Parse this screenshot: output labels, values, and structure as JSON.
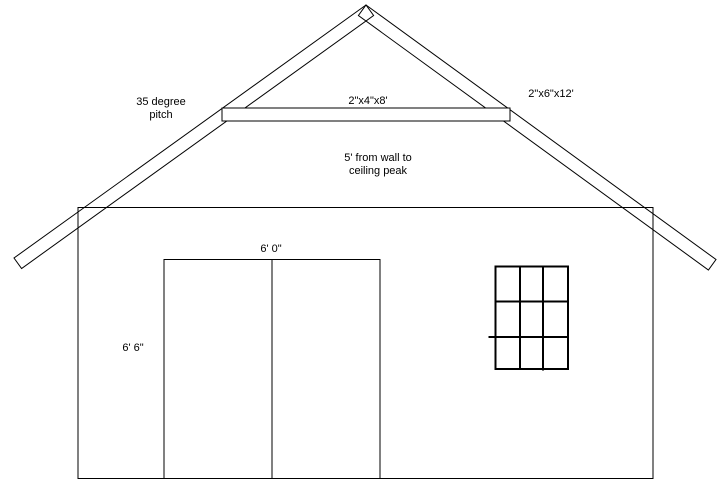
{
  "figure": {
    "labels": {
      "pitch_line1": "35 degree",
      "pitch_line2": "pitch",
      "collar_tie_size": "2\"x4\"x8'",
      "rafter_size": "2\"x6\"x12'",
      "peak_height_line1": "5' from wall to",
      "peak_height_line2": "ceiling peak",
      "door_width": "6' 0\"",
      "door_height": "6' 6\""
    },
    "colors": {
      "line": "#000000",
      "background": "#ffffff"
    }
  }
}
